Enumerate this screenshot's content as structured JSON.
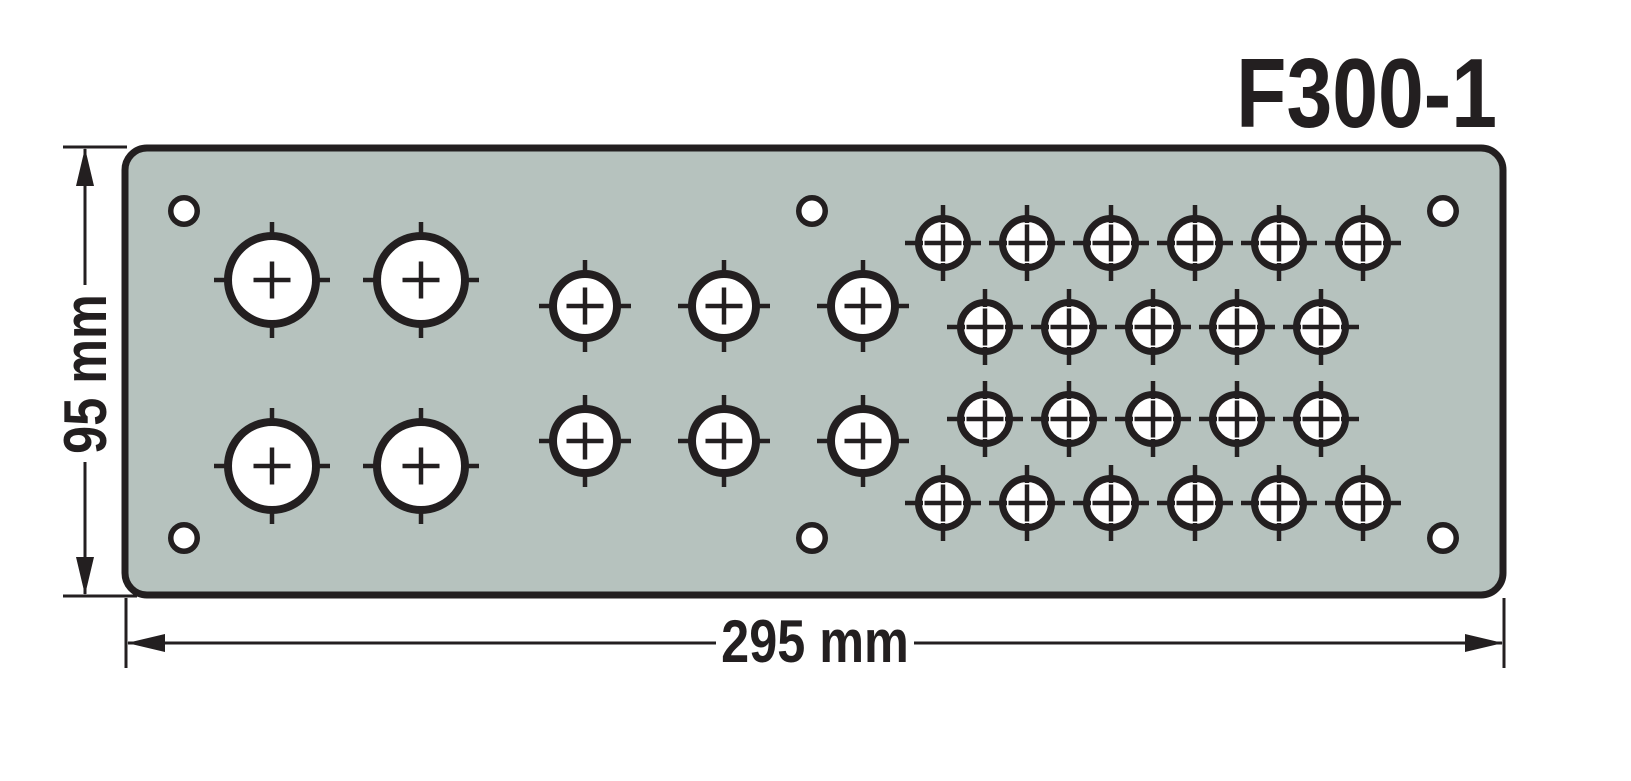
{
  "title": "F300-1",
  "dimensions": {
    "height_label": "95 mm",
    "width_label": "295 mm"
  },
  "colors": {
    "background": "#ffffff",
    "plate_fill": "#b6c2be",
    "line": "#231f20",
    "hole_fill": "#ffffff"
  },
  "plate": {
    "x": 125,
    "y": 148,
    "width": 1378,
    "height": 447,
    "corner_radius": 22
  },
  "holes": {
    "large": {
      "outer_radius": 48,
      "count": 4,
      "positions": [
        [
          272,
          280
        ],
        [
          421,
          280
        ],
        [
          272,
          466
        ],
        [
          421,
          466
        ]
      ]
    },
    "medium": {
      "outer_radius": 36,
      "count": 6,
      "positions": [
        [
          585,
          306
        ],
        [
          724,
          306
        ],
        [
          863,
          306
        ],
        [
          585,
          441
        ],
        [
          724,
          441
        ],
        [
          863,
          441
        ]
      ]
    },
    "small": {
      "outer_radius": 28,
      "count": 22,
      "positions": [
        [
          943,
          243
        ],
        [
          1027,
          243
        ],
        [
          1111,
          243
        ],
        [
          1195,
          243
        ],
        [
          1279,
          243
        ],
        [
          1363,
          243
        ],
        [
          985,
          327
        ],
        [
          1069,
          327
        ],
        [
          1153,
          327
        ],
        [
          1237,
          327
        ],
        [
          1321,
          327
        ],
        [
          985,
          419
        ],
        [
          1069,
          419
        ],
        [
          1153,
          419
        ],
        [
          1237,
          419
        ],
        [
          1321,
          419
        ],
        [
          943,
          503
        ],
        [
          1027,
          503
        ],
        [
          1111,
          503
        ],
        [
          1195,
          503
        ],
        [
          1279,
          503
        ],
        [
          1363,
          503
        ]
      ]
    },
    "mounting": {
      "outer_radius": 16,
      "count": 6,
      "positions": [
        [
          184,
          211
        ],
        [
          812,
          211
        ],
        [
          1443,
          211
        ],
        [
          184,
          538
        ],
        [
          812,
          538
        ],
        [
          1443,
          538
        ]
      ]
    }
  }
}
